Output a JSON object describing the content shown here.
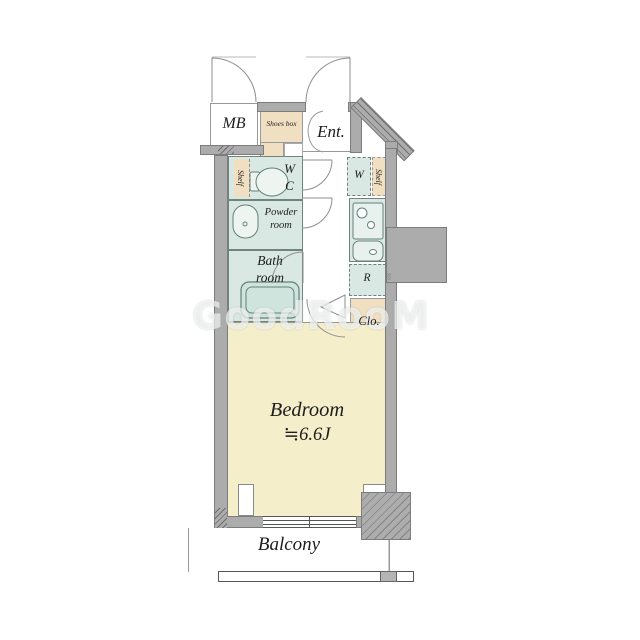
{
  "watermark": {
    "text": "GoodRooM"
  },
  "rooms": {
    "mb": {
      "label": "MB"
    },
    "shoes_box": {
      "label": "Shoes box"
    },
    "entrance": {
      "label": "Ent."
    },
    "wc": {
      "label": "WC",
      "shelf_label": "Shelf"
    },
    "powder_room": {
      "label": "Powder room"
    },
    "bath_room": {
      "label": "Bath room"
    },
    "washer": {
      "label": "W",
      "shelf_label": "Shelf"
    },
    "kitchen": {
      "dim_label": "555"
    },
    "fridge": {
      "label": "R"
    },
    "closet": {
      "label": "Clo."
    },
    "bedroom": {
      "label": "Bedroom",
      "size": "≒6.6J"
    },
    "balcony": {
      "label": "Balcony"
    }
  },
  "colors": {
    "wall": "#acacac",
    "wet_area": "#d9e8e2",
    "storage": "#f1dfc2",
    "bedroom_floor": "#f5eecb"
  }
}
